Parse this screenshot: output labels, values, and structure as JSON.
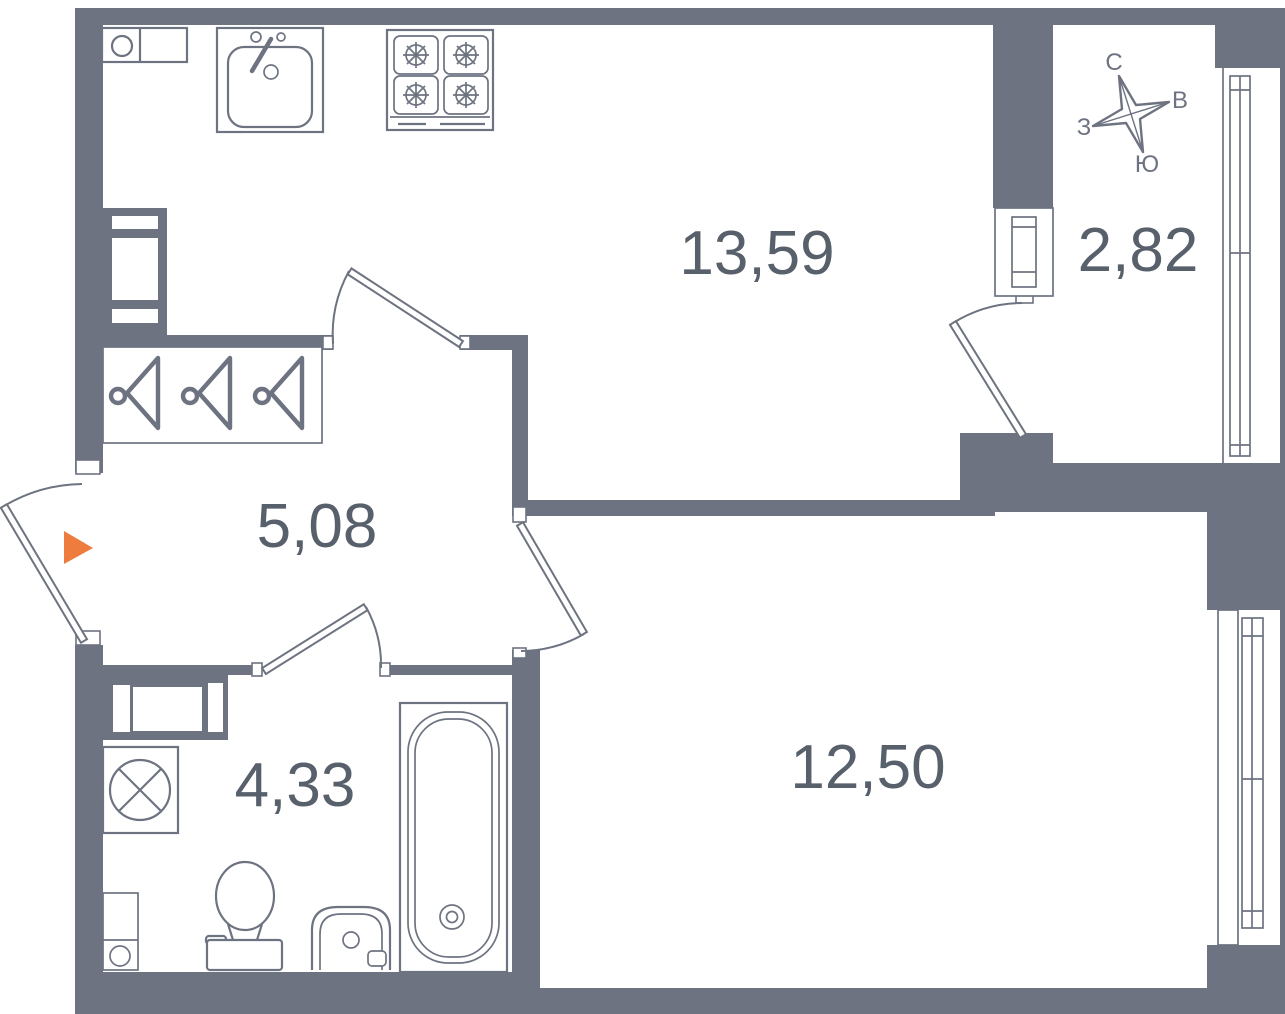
{
  "floor_plan": {
    "rooms": [
      {
        "name": "kitchen-living-room",
        "area": "13,59"
      },
      {
        "name": "balcony",
        "area": "2,82"
      },
      {
        "name": "hallway",
        "area": "5,08"
      },
      {
        "name": "bathroom",
        "area": "4,33"
      },
      {
        "name": "room",
        "area": "12,50"
      }
    ],
    "compass": {
      "north": "С",
      "east": "В",
      "west": "З",
      "south": "Ю"
    },
    "colors": {
      "wall": "#6d7380",
      "fixture_line": "#6d7380",
      "label_text": "#57606b",
      "entrance_arrow": "#ef7c3f",
      "background": "#ffffff"
    }
  }
}
